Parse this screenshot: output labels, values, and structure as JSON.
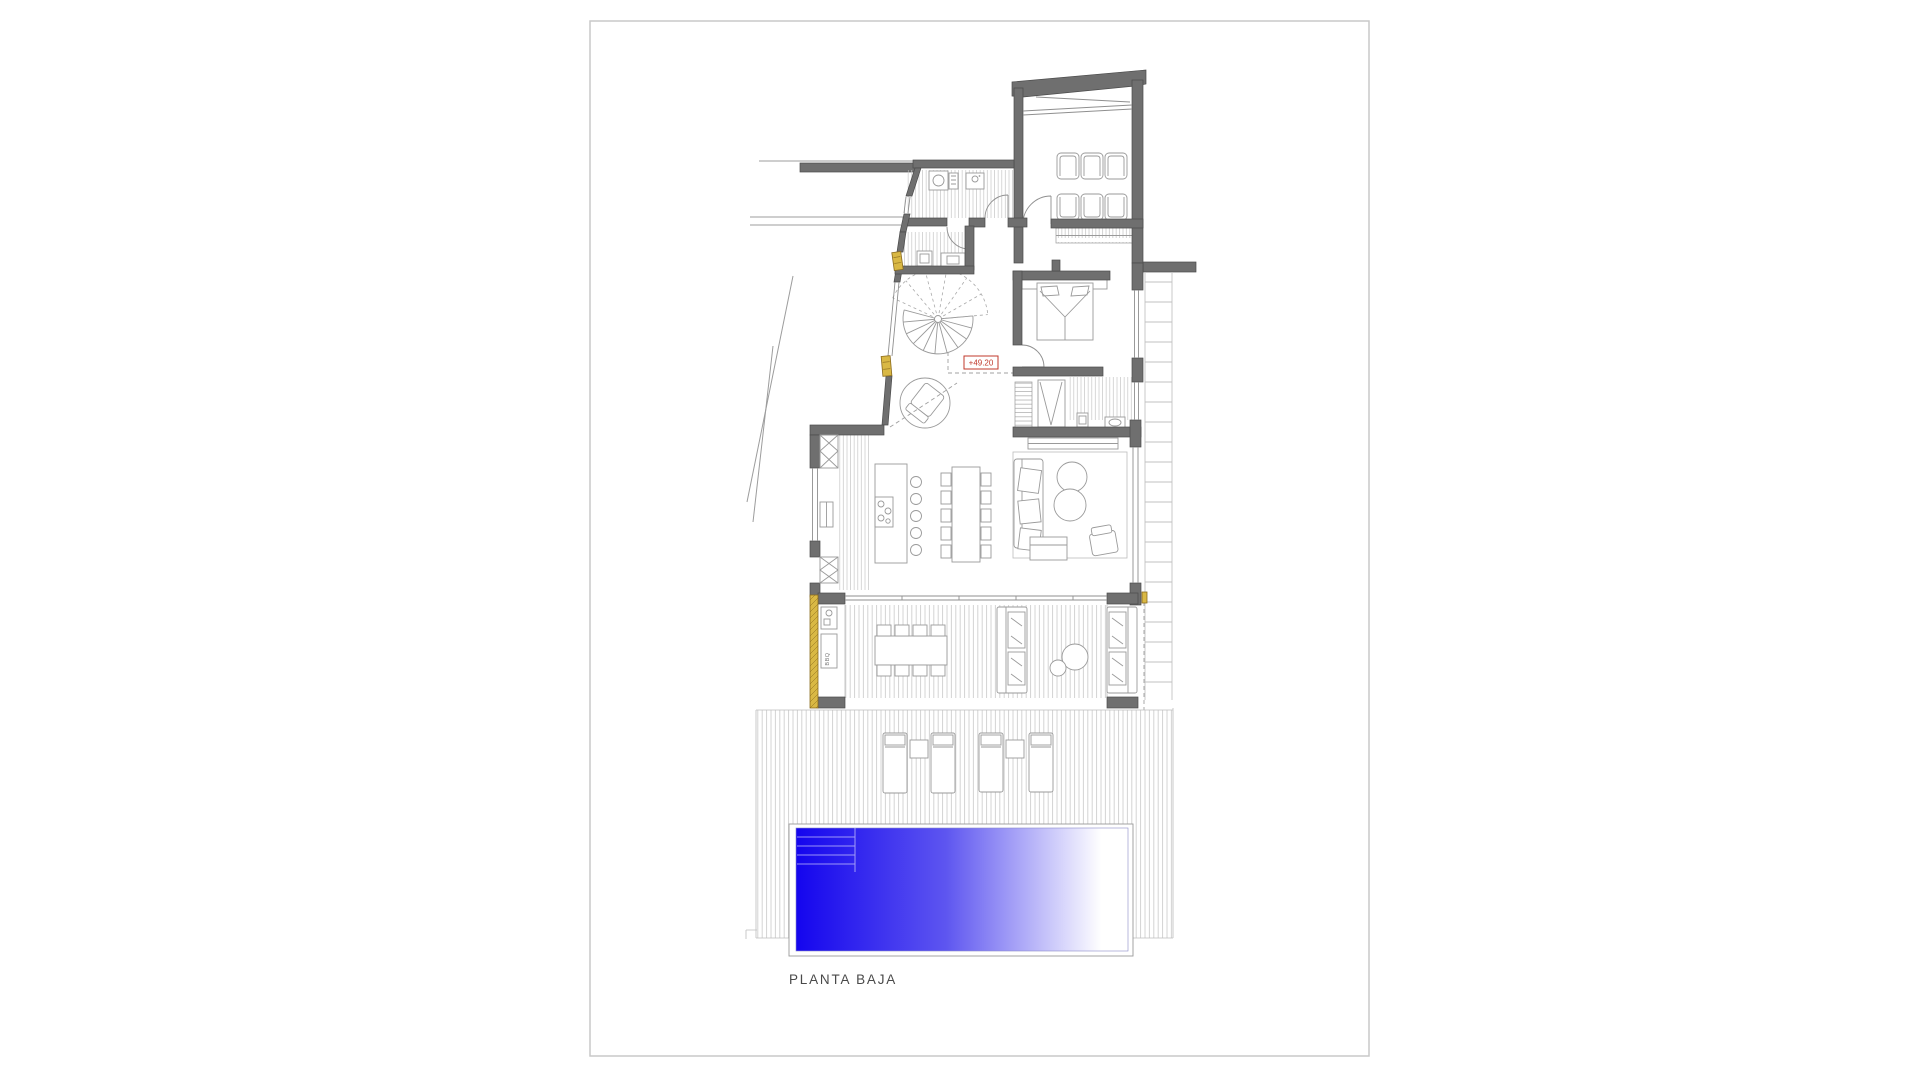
{
  "drawing": {
    "title": "PLANTA BAJA",
    "level_label": "+49.20",
    "bbq_label": "BBQ"
  },
  "colors": {
    "wall_gray": "#6f6f6f",
    "page_border": "#c9c9c9",
    "accent_yellow": "#d9b844",
    "level_label_red": "#c0392b",
    "pool_blue": "#1405ee",
    "pool_mid": "#5d55f0",
    "pool_fade": "#ffffff"
  }
}
